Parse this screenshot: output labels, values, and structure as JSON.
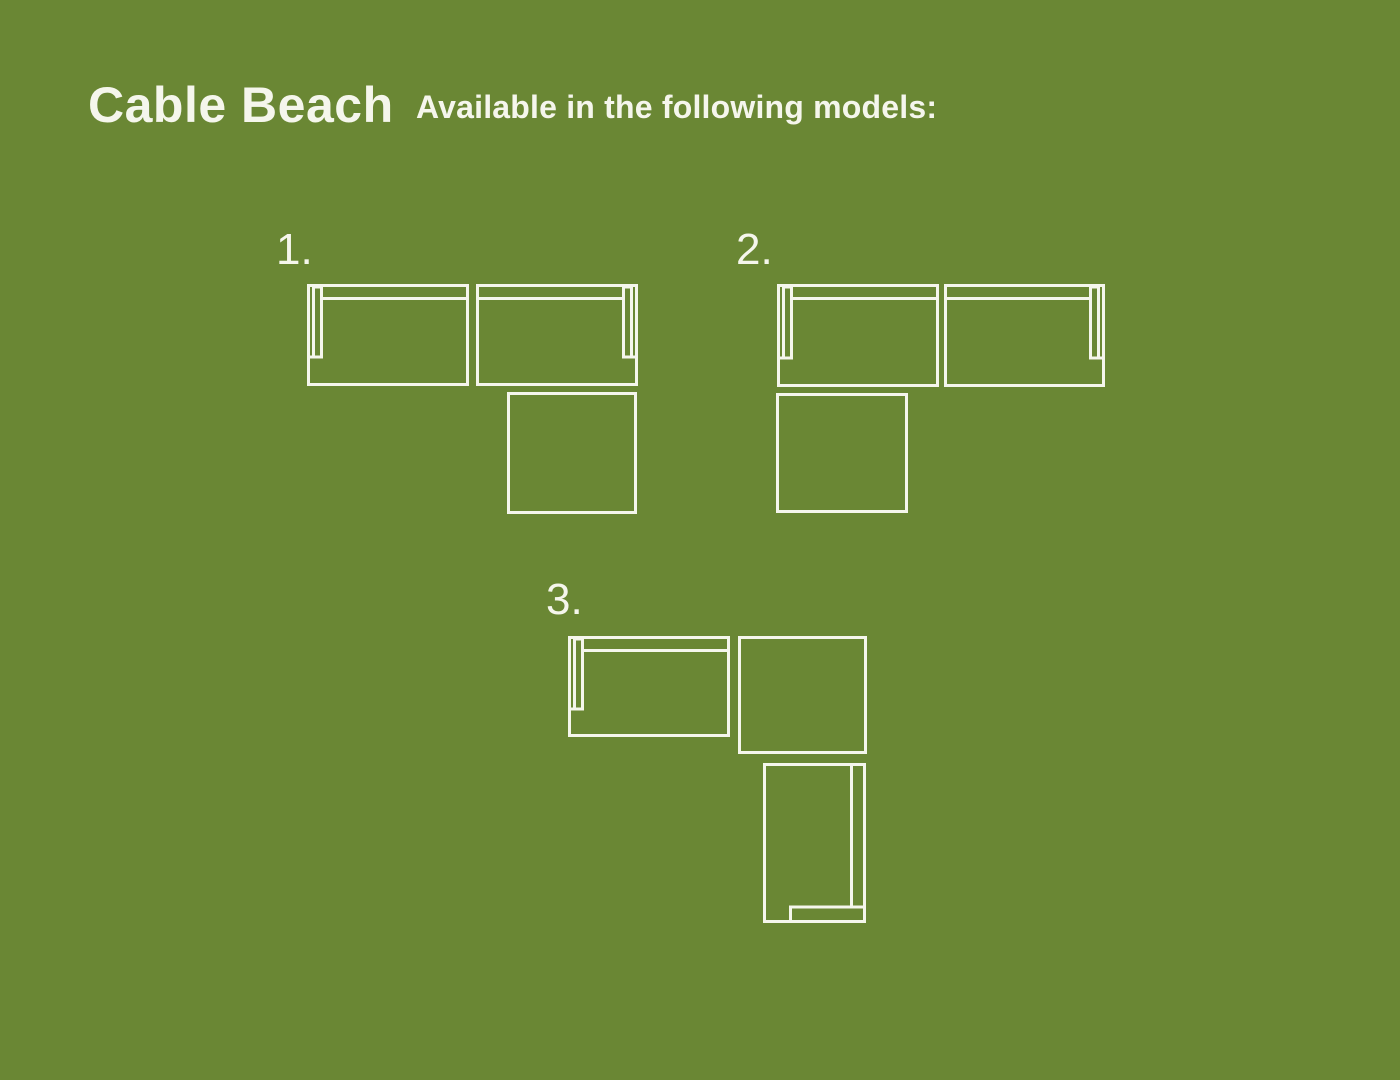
{
  "canvas": {
    "width": 1400,
    "height": 1080,
    "background_color": "#6a8734",
    "line_color": "#f5f6ec",
    "text_color": "#f5f6ec",
    "stroke_width": 3
  },
  "header": {
    "title": "Cable Beach",
    "subtitle": "Available in the following models:"
  },
  "models": [
    {
      "id": 1,
      "label": "1.",
      "label_left": 276,
      "label_top": 228,
      "pieces": [
        {
          "name": "sofa-left-arm",
          "x": 307,
          "y": 284,
          "w": 162,
          "h": 102
        },
        {
          "name": "sofa-right-arm",
          "x": 476,
          "y": 284,
          "w": 162,
          "h": 102
        },
        {
          "name": "corner-ottoman",
          "x": 507,
          "y": 392,
          "w": 130,
          "h": 122
        }
      ]
    },
    {
      "id": 2,
      "label": "2.",
      "label_left": 736,
      "label_top": 228,
      "pieces": [
        {
          "name": "sofa-left-arm",
          "x": 777,
          "y": 284,
          "w": 162,
          "h": 103
        },
        {
          "name": "sofa-right-arm",
          "x": 944,
          "y": 284,
          "w": 161,
          "h": 103
        },
        {
          "name": "corner-ottoman",
          "x": 776,
          "y": 393,
          "w": 132,
          "h": 120
        }
      ]
    },
    {
      "id": 3,
      "label": "3.",
      "label_left": 546,
      "label_top": 578,
      "pieces": [
        {
          "name": "sofa-left-arm",
          "x": 568,
          "y": 636,
          "w": 162,
          "h": 101
        },
        {
          "name": "corner-ottoman",
          "x": 738,
          "y": 636,
          "w": 129,
          "h": 118
        },
        {
          "name": "chaise-vertical-back-right",
          "x": 763,
          "y": 763,
          "w": 103,
          "h": 160
        }
      ]
    }
  ]
}
